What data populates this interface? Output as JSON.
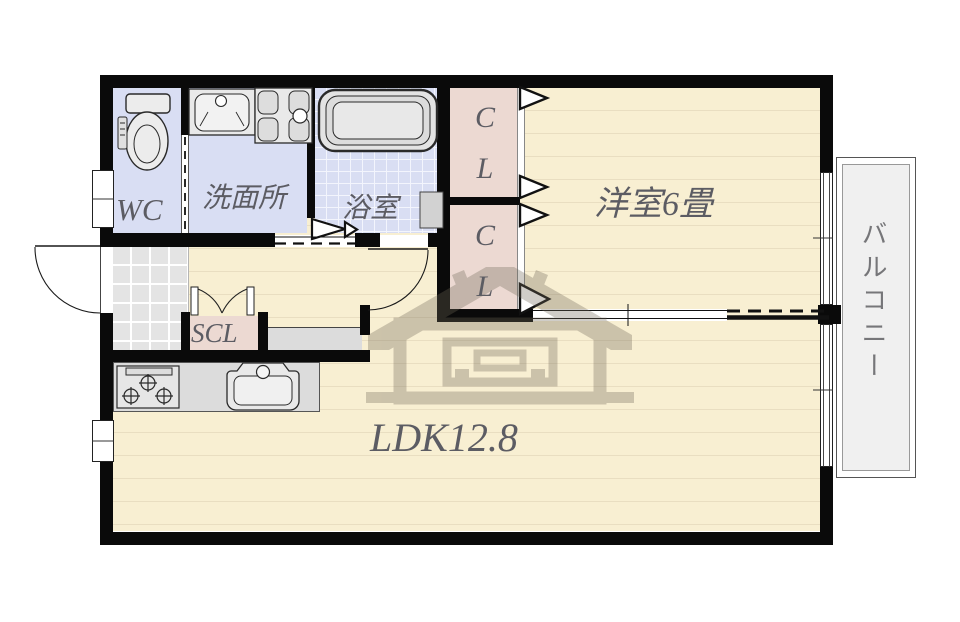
{
  "title": "apartment floor plan",
  "rooms": {
    "wc": {
      "label": "WC"
    },
    "washroom": {
      "label": "洗面所"
    },
    "bathroom": {
      "label": "浴室"
    },
    "closet_upper": {
      "line1": "C",
      "line2": "L"
    },
    "closet_lower": {
      "line1": "C",
      "line2": "L"
    },
    "western_room": {
      "label": "洋室6畳"
    },
    "ldk": {
      "label": "LDK12.8"
    },
    "scl": {
      "label": "SCL"
    },
    "balcony": {
      "label": "バルコニー"
    }
  },
  "watermark": {
    "symbol": "商"
  },
  "colors": {
    "flooring": "#f8efd2",
    "flooring_line": "#e9dec1",
    "wet_room": "#d9def3",
    "closet": "#ecd9d2",
    "entrance_tile": "#e4e4e4",
    "counter": "#dcdcdc",
    "balcony": "#f0f0f0",
    "wall": "#0a0a0a",
    "label_text": "#5c5c63",
    "watermark": "#6f6757"
  }
}
